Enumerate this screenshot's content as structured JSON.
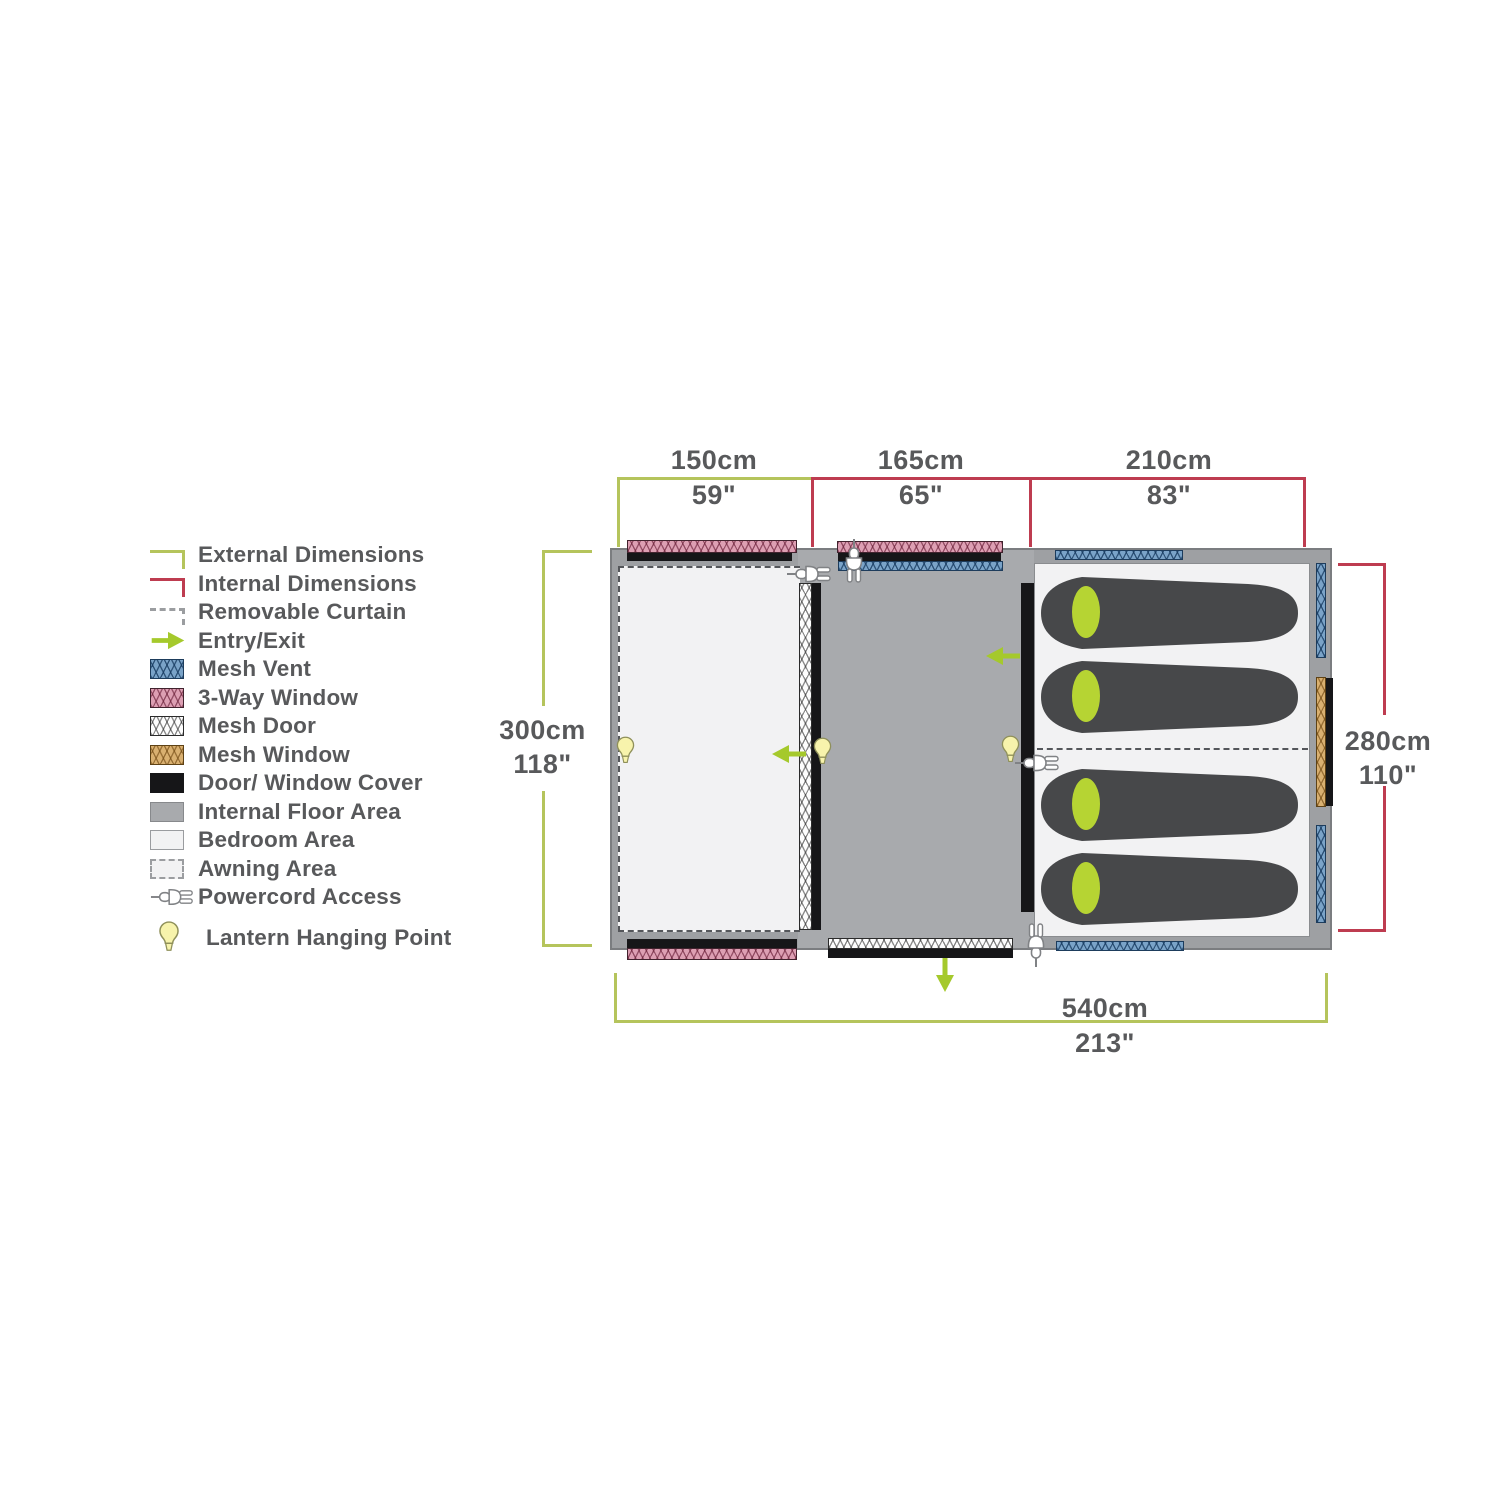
{
  "title": "Tent floor plan with dimensions",
  "legend": {
    "items": [
      {
        "label": "External Dimensions",
        "icon": "external-dimensions-bracket"
      },
      {
        "label": "Internal Dimensions",
        "icon": "internal-dimensions-bracket"
      },
      {
        "label": "Removable Curtain",
        "icon": "removable-curtain-dashes"
      },
      {
        "label": "Entry/Exit",
        "icon": "entry-exit-arrow"
      },
      {
        "label": "Mesh Vent",
        "icon": "mesh-vent-swatch"
      },
      {
        "label": "3-Way Window",
        "icon": "three-way-window-swatch"
      },
      {
        "label": "Mesh Door",
        "icon": "mesh-door-swatch"
      },
      {
        "label": "Mesh Window",
        "icon": "mesh-window-swatch"
      },
      {
        "label": "Door/ Window Cover",
        "icon": "door-window-cover-swatch"
      },
      {
        "label": "Internal Floor Area",
        "icon": "internal-floor-swatch"
      },
      {
        "label": "Bedroom Area",
        "icon": "bedroom-area-swatch"
      },
      {
        "label": "Awning Area",
        "icon": "awning-area-swatch"
      },
      {
        "label": "Powercord Access",
        "icon": "powercord-plug-icon"
      },
      {
        "label": "Lantern Hanging Point",
        "icon": "lantern-bulb-icon"
      }
    ]
  },
  "dimensions": {
    "top_sections": [
      {
        "cm": "150cm",
        "inches": "59\"",
        "type": "external"
      },
      {
        "cm": "165cm",
        "inches": "65\"",
        "type": "internal"
      },
      {
        "cm": "210cm",
        "inches": "83\"",
        "type": "internal"
      }
    ],
    "left": {
      "cm": "300cm",
      "inches": "118\"",
      "type": "external"
    },
    "right": {
      "cm": "280cm",
      "inches": "110\"",
      "type": "internal"
    },
    "bottom": {
      "cm": "540cm",
      "inches": "213\"",
      "type": "external"
    }
  },
  "plan": {
    "rooms": [
      "Awning Area",
      "Internal Floor Area",
      "Bedroom Area"
    ],
    "sleeping_bag_count": 4,
    "lantern_count": 3,
    "powercord_count": 4,
    "entry_exit_count": 3
  },
  "colors": {
    "external_dimension": "#B5C45C",
    "internal_dimension": "#BE3C50",
    "entry_exit_arrow": "#A5C92C",
    "mesh_vent": "#7AA3C8",
    "three_way_window": "#DD9FB3",
    "mesh_door": "#FDFDFD",
    "mesh_window": "#D9B070",
    "door_window_cover": "#161618",
    "internal_floor": "#A8AAAD",
    "bedroom_area": "#F2F2F3",
    "tent_wall": "#9EA0A3",
    "sleeping_bag": "#47484A",
    "sleeping_bag_pillow": "#B6D433",
    "lantern_fill": "#F7F3AC",
    "label_text": "#58595B"
  }
}
